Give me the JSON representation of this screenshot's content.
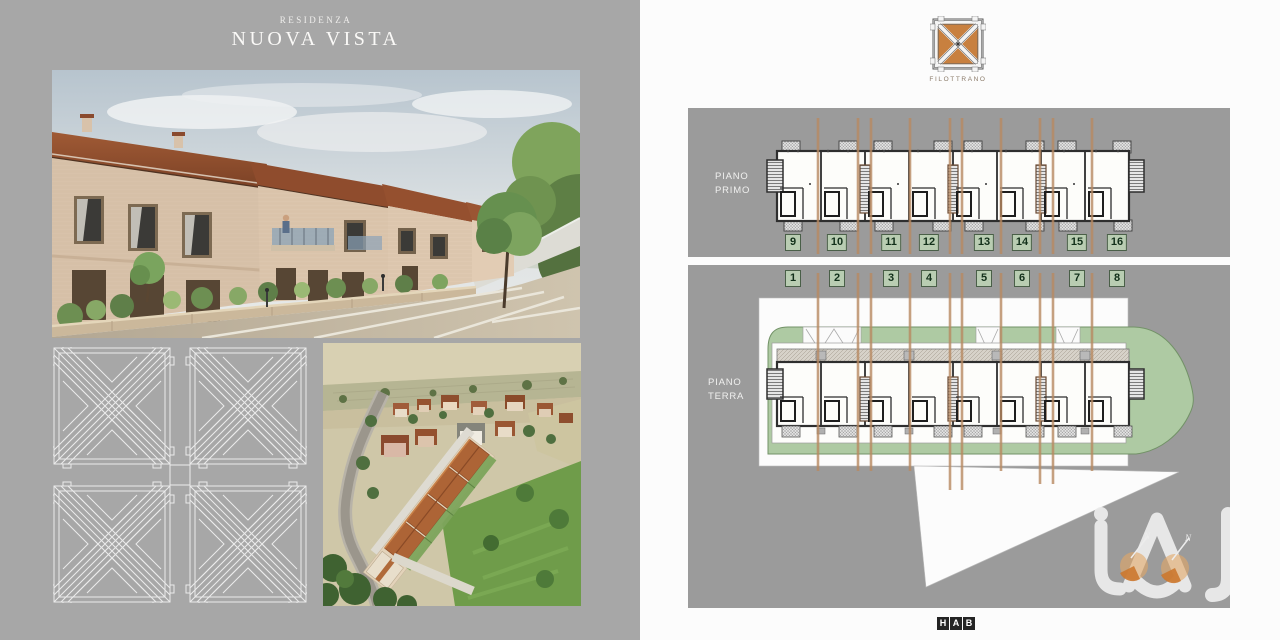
{
  "left_page": {
    "subtitle": "RESIDENZA",
    "title": "NUOVA VISTA",
    "images": {
      "main_render": "street-view-render-of-brick-townhouses-with-parking",
      "pattern": "white-line-geometric-tile-pattern",
      "aerial": "aerial-render-of-residential-complex"
    }
  },
  "right_page": {
    "logo_caption": "FILOTTRANO",
    "floors": {
      "primo": {
        "label_line1": "PIANO",
        "label_line2": "PRIMO",
        "units": [
          "9",
          "10",
          "11",
          "12",
          "13",
          "14",
          "15",
          "16"
        ]
      },
      "terra": {
        "label_line1": "PIANO",
        "label_line2": "TERRA",
        "units": [
          "1",
          "2",
          "3",
          "4",
          "5",
          "6",
          "7",
          "8"
        ]
      }
    },
    "footer_letters": [
      "H",
      "A",
      "B"
    ]
  },
  "icons": {
    "brand_logo": "filottrano-tile-logo",
    "watermark": "agency-watermark-orange-dots"
  },
  "colors": {
    "left_bg": "#a7a7a7",
    "right_bg": "#fcfcfc",
    "panel_bg": "#9b9b9b",
    "badge_bg": "#b9cdb2",
    "badge_border": "#4a5f48",
    "section_line": "#b88a62",
    "logo_orange": "#c8803f",
    "plan_green": "#aecaa3",
    "watermark_orange": "#e0913f"
  }
}
